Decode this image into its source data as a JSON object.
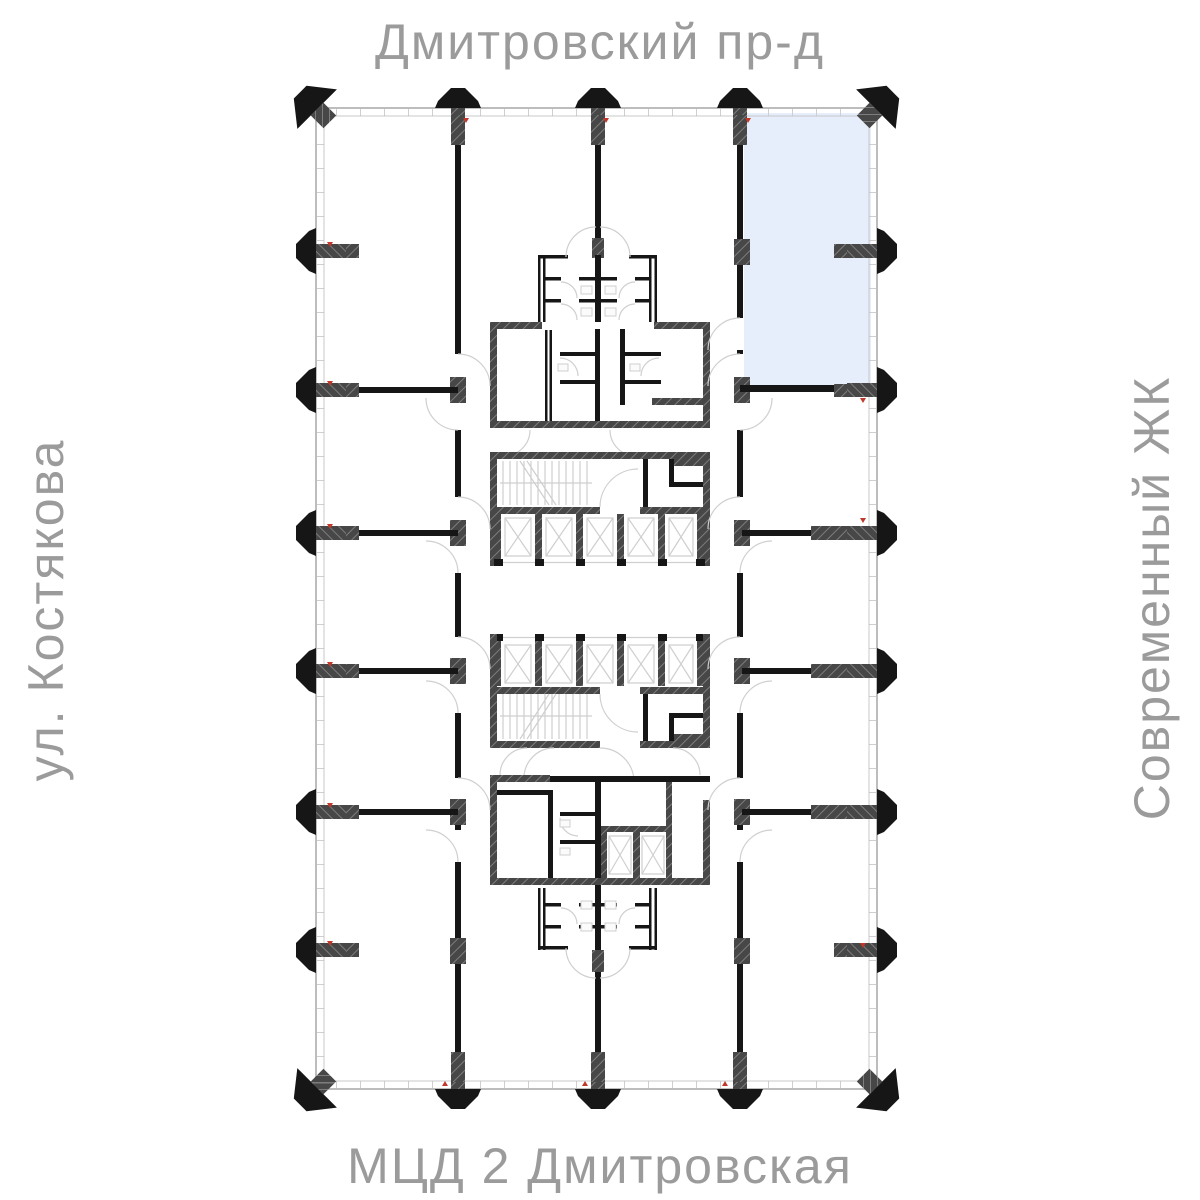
{
  "labels": {
    "street_top": "Дмитровский пр-д",
    "street_bottom": "МЦД 2 Дмитровская",
    "street_left": "ул. Костякова",
    "street_right": "Современный ЖК"
  },
  "colors": {
    "background": "#ffffff",
    "label_gray": "#9b9b9b",
    "wall_black": "#161616",
    "structure_dark": "#474747",
    "structure_hatch_light": "#7d7d7d",
    "facade_line": "#bdbdbd",
    "detail_line": "#cfcfcf",
    "highlight_fill": "#e7eefb",
    "marker_red": "#c0392b"
  },
  "plan": {
    "type": "residential-floor-plan",
    "highlighted_unit": {
      "location": "top-right",
      "state": "selected"
    }
  }
}
